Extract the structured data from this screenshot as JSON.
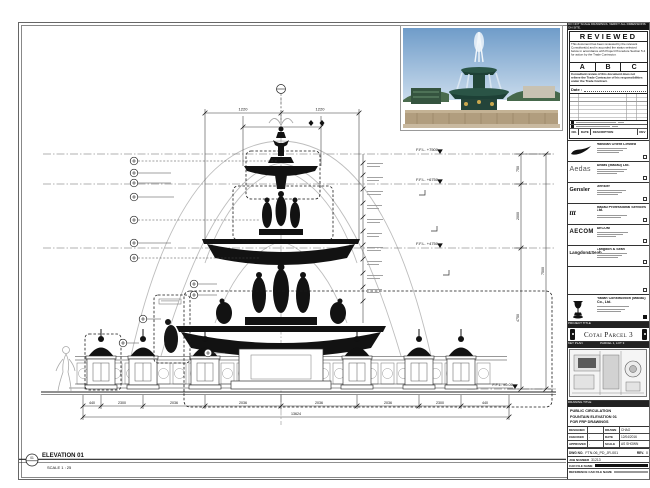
{
  "sheet": {
    "top_note": "DO NOT SCALE DRAWINGS. VERIFY ALL DIMENSIONS ON SITE.",
    "stamp": {
      "title": "REVIEWED",
      "para1": "This document has been reviewed by the relevant Consultant(s) and is accorded the status selected below in accordance with Project Procedure Section 5.4 for action by the Trade Contractor.",
      "options": [
        "A",
        "B",
        "C"
      ],
      "para2": "Consultant review of this document does not relieve the Trade Contractor of his responsibilities under the Trade Contract.",
      "date_label": "Date :"
    },
    "log_header": {
      "no": "NO.",
      "date": "DATE",
      "description": "DESCRIPTION",
      "rev": "REV"
    }
  },
  "consultants": [
    {
      "name": "Handian Orient Limited"
    },
    {
      "logo": "Aedas",
      "name": "Aedas (Macau) Ltd."
    },
    {
      "logo": "Gensler",
      "name": "Gensler"
    },
    {
      "logo": "ttt",
      "name": "Macau Professional Services Ltd."
    },
    {
      "logo": "AECOM",
      "name": "AECOM"
    },
    {
      "logo": "Langdon&Seah",
      "name": "Langdon & Seah"
    }
  ],
  "contractor": {
    "name": "Yadan Construction (Macau) Co., Ltd."
  },
  "project": {
    "label": "PROJECT TITLE",
    "title": "Cotai Parcel 3"
  },
  "key_plan": {
    "label": "KEY PLAN",
    "note": "PARCEL 1, LOT 3"
  },
  "drawing_title": {
    "label": "DRAWING TITLE",
    "line1": "PUBLIC CIRCULATION",
    "line2": "FOUNTAIN ELEVATION 01",
    "line3": "FOR FRP DRAWINGS"
  },
  "fields": {
    "designed_label": "DESIGNED",
    "designed": "",
    "drawn_label": "DRAWN",
    "drawn": "CHAO",
    "checked_label": "CHECKED",
    "checked": "-",
    "date_label": "DATE",
    "date": "12/04/2016",
    "approved_label": "APPROVED",
    "approved": "-",
    "scale_label": "SCALE",
    "scale": "AS SHOWN",
    "dwg_label": "DWG NO.",
    "dwg_no": "FTN-06_PD_JR-001",
    "rev_label": "REV.",
    "rev": "0",
    "job_label": "JOB NUMBER",
    "job": "31213",
    "cad_label": "CAD FILE NAME",
    "ref_label": "REFERENCE CAD FILE NAME"
  },
  "elevation_label": {
    "bubble": "01",
    "title": "ELEVATION 01",
    "scale": "SCALE 1 : 25"
  },
  "levels": [
    "F.F.L. +7500",
    "F.F.L. +6750",
    "F.F.L. +4750",
    "F.F.L. ±0.00"
  ],
  "dims": {
    "top": [
      "1220",
      "1220"
    ],
    "right": [
      "750",
      "2000",
      "4750",
      "7500"
    ],
    "bottom": [
      "440",
      "2300",
      "2036",
      "2036",
      "2036",
      "2036",
      "2300",
      "440"
    ],
    "total": "13624"
  }
}
